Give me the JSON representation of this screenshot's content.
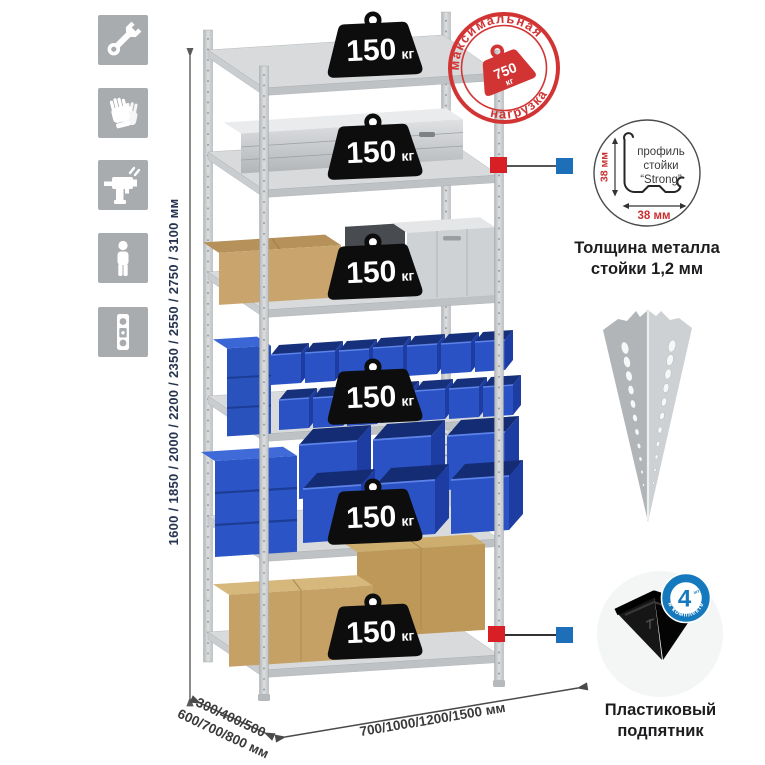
{
  "page": {
    "background": "#ffffff"
  },
  "icon_strip": {
    "tile_color": "#a8acaf",
    "items": [
      {
        "name": "wrench"
      },
      {
        "name": "gloves"
      },
      {
        "name": "drill"
      },
      {
        "name": "person"
      },
      {
        "name": "level"
      }
    ]
  },
  "dimensions": {
    "height": "1600 / 1850 / 2000 / 2200 / 2350 / 2550 / 2750 / 3100 мм",
    "depth_line1": "300/400/500",
    "depth_line2": "600/700/800 мм",
    "width": "700/1000/1200/1500 мм"
  },
  "shelf_loads": [
    {
      "value": "150",
      "unit": "кг"
    },
    {
      "value": "150",
      "unit": "кг"
    },
    {
      "value": "150",
      "unit": "кг"
    },
    {
      "value": "150",
      "unit": "кг"
    },
    {
      "value": "150",
      "unit": "кг"
    },
    {
      "value": "150",
      "unit": "кг"
    }
  ],
  "max_load_stamp": {
    "arc_top": "максимальная",
    "arc_bottom": "нагрузка",
    "value": "750",
    "unit": "кг",
    "color": "#d23434"
  },
  "profile_callout": {
    "labels": [
      "профиль",
      "стойки",
      "“Strong”"
    ],
    "dim_vertical": "38 мм",
    "dim_horizontal": "38 мм",
    "caption1": "Толщина металла",
    "caption2": "стойки 1,2 мм"
  },
  "foot_callout": {
    "badge_count": "4",
    "badge_word": "штуки",
    "badge_arc": "в комплекте",
    "caption1": "Пластиковый",
    "caption2": "подпятник"
  },
  "colors": {
    "accent_red": "#d81f26",
    "accent_blue": "#1c6fb8",
    "bin_blue": "#2a52c4",
    "stamp_red": "#d23434",
    "badge_blue": "#1779bd"
  }
}
